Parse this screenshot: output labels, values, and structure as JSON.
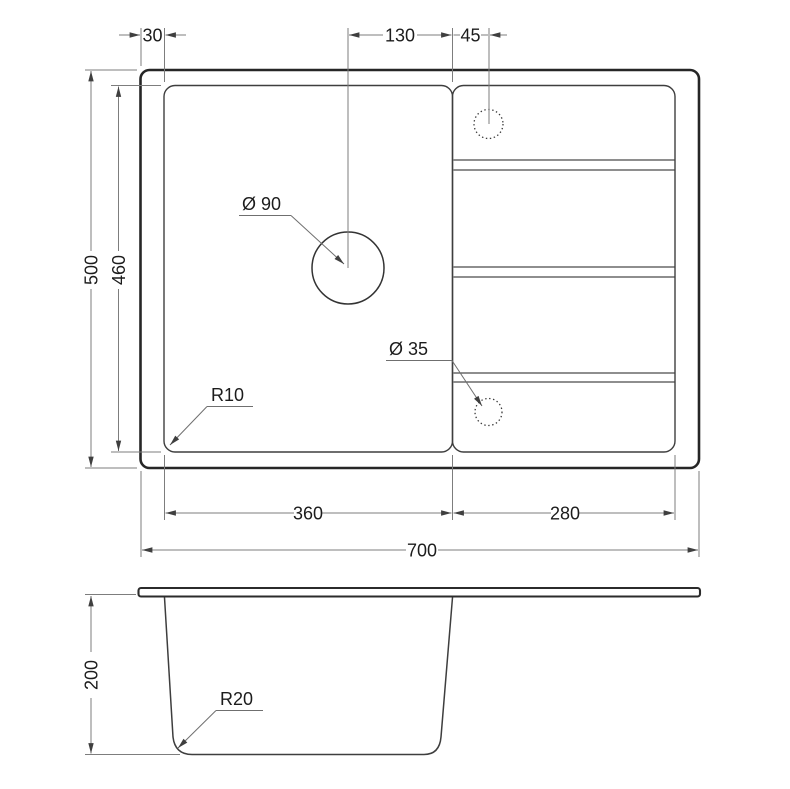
{
  "drawing": {
    "type": "sink-technical-drawing",
    "colors": {
      "background": "#ffffff",
      "outline_dark": "#262626",
      "line_medium": "#3e3e3e",
      "dimension_line": "#7d7d7d",
      "text": "#1c1c1c"
    },
    "top_view": {
      "dimensions": {
        "rim_inset_left": "30",
        "drain_center_to_divider": "130",
        "divider_to_tap_hole": "45",
        "overall_depth": "500",
        "inner_depth": "460",
        "bowl_width": "360",
        "drainboard_width": "280",
        "overall_width": "700"
      },
      "labels": {
        "drain_hole_diameter": "Ø 90",
        "small_hole_diameter": "Ø 35",
        "bowl_corner_radius": "R10"
      }
    },
    "side_view": {
      "dimensions": {
        "bowl_depth": "200"
      },
      "labels": {
        "bottom_corner_radius": "R20"
      }
    }
  }
}
